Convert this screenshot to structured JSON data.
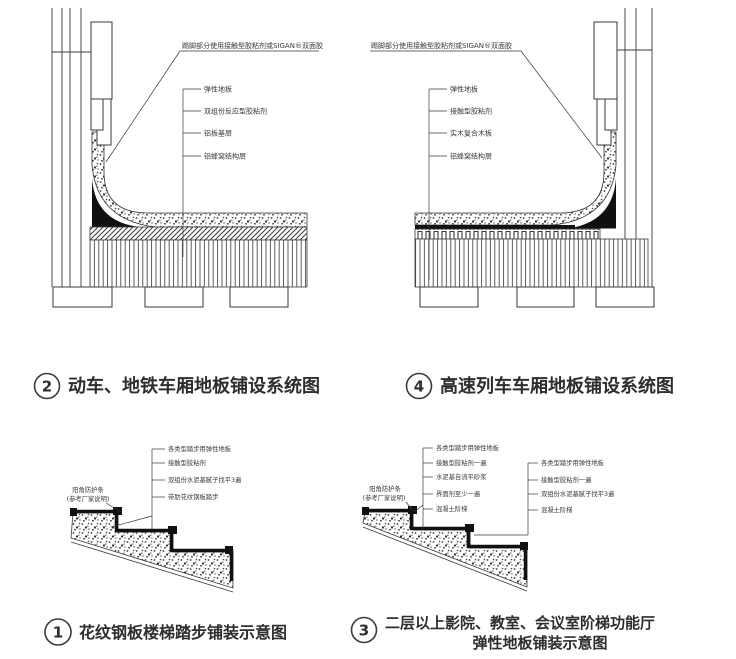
{
  "diagram2": {
    "top_label": "踢脚部分使用接触型胶粘剂或SIGAN®双面胶",
    "labels": [
      "弹性地板",
      "双组份反应型胶粘剂",
      "铝板基层",
      "铝蜂窝结构层"
    ],
    "title_num": "2",
    "title": "动车、地铁车厢地板铺设系统图"
  },
  "diagram4": {
    "top_label": "踢脚部分使用接触型胶粘剂或SIGAN®双面胶",
    "labels": [
      "弹性地板",
      "接触型胶粘剂",
      "实木复合木板",
      "铝蜂窝结构层"
    ],
    "title_num": "4",
    "title": "高速列车车厢地板铺设系统图"
  },
  "diagram1": {
    "corner_label": [
      "阳角防护条",
      "(参考厂家说明)"
    ],
    "labels": [
      "各类型踏步用弹性地板",
      "接触型胶粘剂",
      "双组份水泥基腻子找平3遍",
      "带肋花纹钢板踏步"
    ],
    "title_num": "1",
    "title": "花纹钢板楼梯踏步铺装示意图"
  },
  "diagram3": {
    "corner_label": [
      "阳角防护条",
      "(参考厂家说明)"
    ],
    "labels_left": [
      "各类型踏步用弹性地板",
      "接触型胶粘剂一遍",
      "水泥基自流平砂浆",
      "界面剂至少一遍",
      "混凝土阶梯"
    ],
    "labels_right": [
      "各类型踏步用弹性地板",
      "接触型胶粘剂一遍",
      "双组份水泥基腻子找平3遍",
      "混凝土阶梯"
    ],
    "title_num": "3",
    "title_line1": "二层以上影院、教室、会议室阶梯功能厅",
    "title_line2": "弹性地板铺装示意图"
  }
}
